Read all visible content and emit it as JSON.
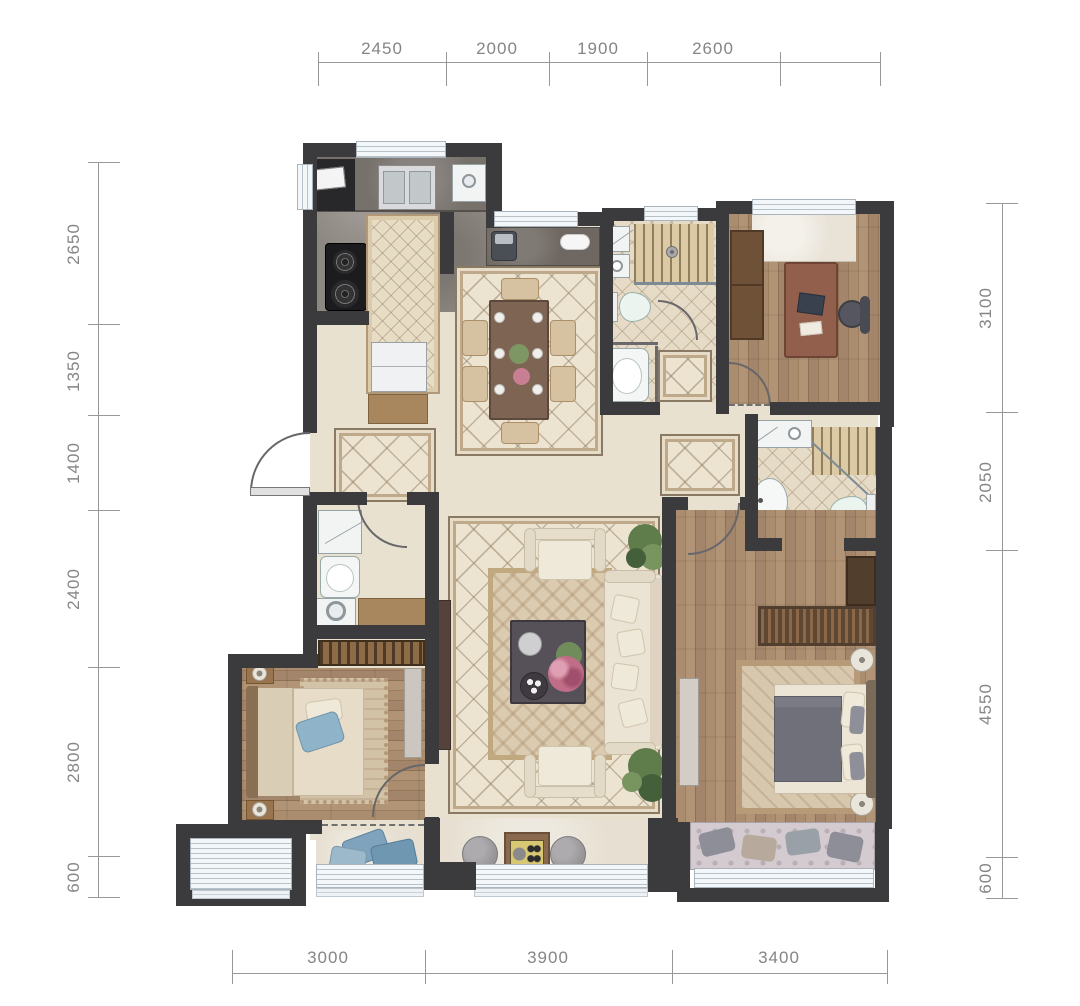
{
  "dimensions": {
    "top": [
      "2450",
      "2000",
      "1900",
      "2600"
    ],
    "left": [
      "2650",
      "1350",
      "1400",
      "2400",
      "2800",
      "600"
    ],
    "right": [
      "3100",
      "2050",
      "4550",
      "600"
    ],
    "bottom": [
      "3000",
      "3900",
      "3400"
    ]
  },
  "colors": {
    "wall": "#3b3a3c",
    "window_fill": "#f4f7f9",
    "window_frame": "#a9b4bc",
    "floor_marble_light": "#e9e1d0",
    "floor_marble_dark": "#8d8781",
    "floor_wood": "#a2856a",
    "floor_bath_tile": "#e6dbc6",
    "dimension_text": "#858585",
    "plant_green": "#5f7c4b",
    "pillow_blue": "#8fb3c8"
  }
}
